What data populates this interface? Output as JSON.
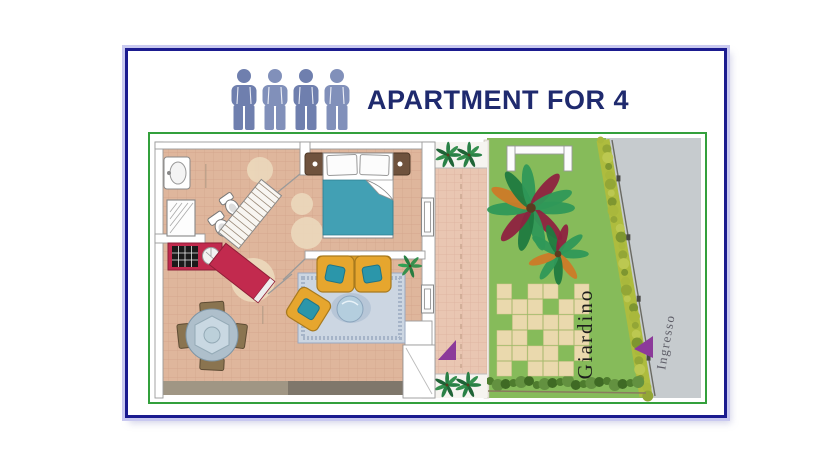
{
  "header": {
    "title": "APARTMENT FOR 4",
    "occupants": 4,
    "person_icon": "person-icon"
  },
  "floor_plan": {
    "labels": {
      "garden": "Giardino",
      "entrance": "Ingresso"
    }
  },
  "colors": {
    "frame_border": "#1b1b8f",
    "frame_halo": "#c9c9f0",
    "title_text": "#1f2a6e",
    "person_icon": "#6f7fae",
    "plan_border": "#33a03c",
    "floor_tile": "#dfb69c",
    "terrace_tile": "#e9c6b2",
    "grass": "#86bb5a",
    "pavement": "#c6cbce",
    "bed_blanket": "#42a0b4",
    "kitchen_counter": "#c22a4e",
    "sofa": "#e6a62e",
    "marker_triangle": "#8c3a9a",
    "garden_label_text": "#1c1c1c",
    "entrance_label_text": "#5e5e68"
  }
}
